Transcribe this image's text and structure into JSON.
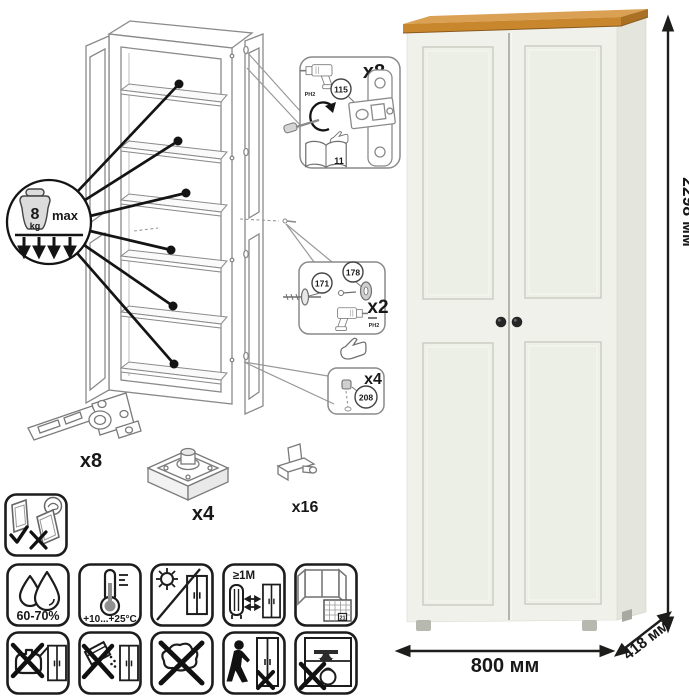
{
  "assembly": {
    "weight_limit": {
      "value": "8",
      "unit": "kg",
      "max": "max"
    },
    "hinge_callout": {
      "count": "x8",
      "part": "115",
      "bit": "PH2",
      "manual_page": "11"
    },
    "cam_callout": {
      "count": "x2",
      "screw_part": "171",
      "cam_part": "178",
      "bit": "PH2"
    },
    "plug_callout": {
      "count": "x4",
      "part": "208"
    },
    "hardware": {
      "hinge_count": "x8",
      "foot_count": "x4",
      "shelf_pin_count": "x16"
    }
  },
  "care": {
    "humidity": "60-70%",
    "temperature": "+10...+25°С",
    "heat_distance": "≥1М",
    "calendar_day": "21"
  },
  "dimensions": {
    "height": "2298 мм",
    "width": "800 мм",
    "depth": "418 мм"
  },
  "colors": {
    "body": "#eff1ea",
    "side": "#e4e6dd",
    "trim_front": "#c8862d",
    "trim_top": "#daa053",
    "trim_side": "#aa7124",
    "knob": "#262626"
  }
}
